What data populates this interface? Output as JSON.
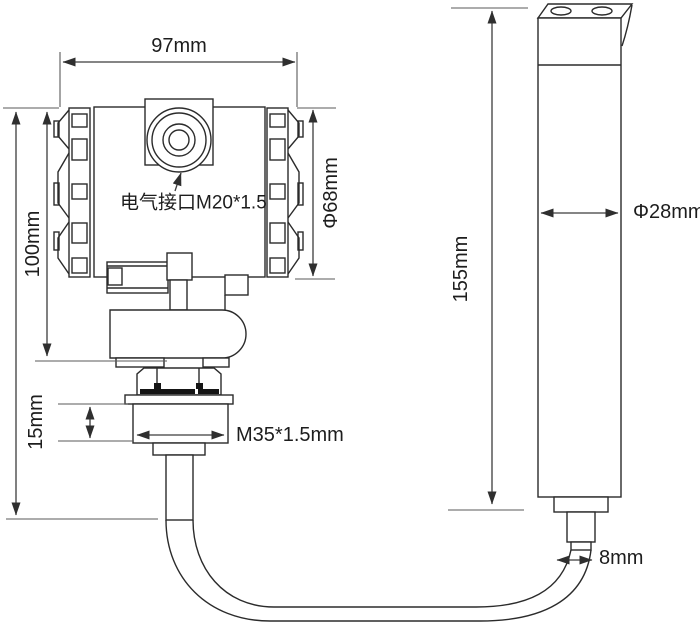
{
  "labels": {
    "dim_97": "97mm",
    "dim_100": "100mm",
    "dia_68": "Φ68mm",
    "electrical_port": "电气接口M20*1.5",
    "dim_15": "15mm",
    "thread_m35": "M35*1.5mm",
    "dim_155": "155mm",
    "dia_28": "Φ28mm",
    "dim_8": "8mm"
  },
  "colors": {
    "background": "#ffffff",
    "part_line": "#2b2b2b",
    "dimension_line": "#3c3c3c",
    "seal_mark": "#151515",
    "text": "#1d1d1d"
  }
}
